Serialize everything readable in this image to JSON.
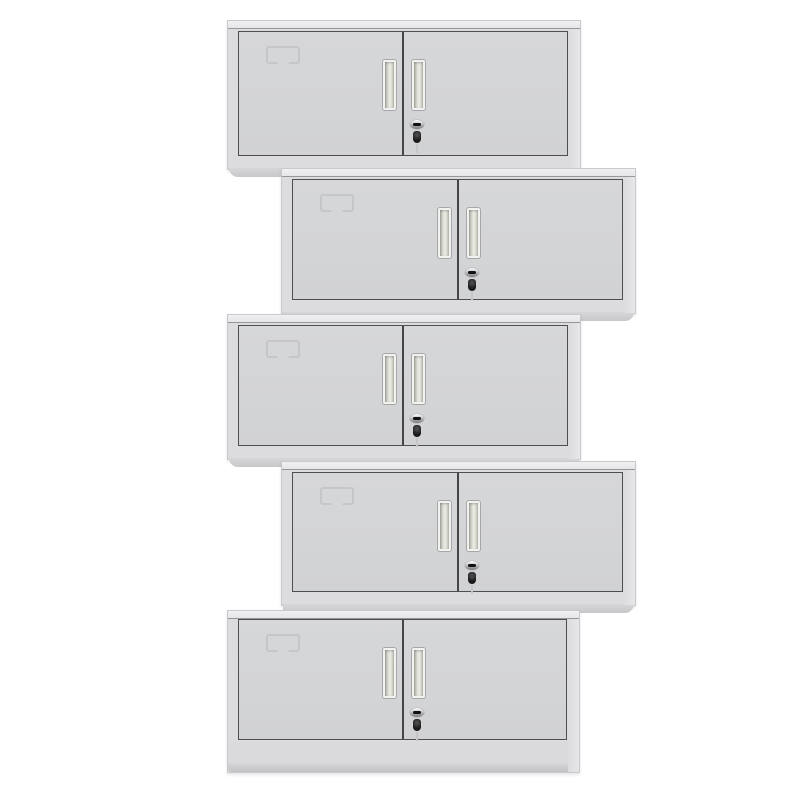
{
  "image": {
    "description": "Product photo: five grey two-door steel office cabinets stacked vertically with alternating left and right offsets on a plain white background",
    "object_count": 5
  },
  "palette": {
    "background": "#ffffff",
    "body": "#dcdcde",
    "body_edge": "#c9c9cd",
    "top_face_light": "#f0f0f2",
    "top_face": "#e6e6e8",
    "top_edge_line": "#97979b",
    "side_highlight": "#e7e7e9",
    "door_fill_top": "#d6d7d9",
    "door_fill_bottom": "#d1d2d4",
    "door_border": "#4e4e52",
    "divider": "#454547",
    "label_line": "#c3c4c6",
    "handle_frame": "#f2f2f0",
    "handle_dark": "#adafa6",
    "handle_mid": "#e0e2d9",
    "handle_light": "#eceee5",
    "handle_end": "#c2c4bb",
    "lock_chrome_light": "#ffffff",
    "lock_chrome_dark": "#77777a",
    "key_black": "#1a1a1a",
    "key_tail": "#c6c6c8",
    "foot_top": "#d6d6d8",
    "foot_bottom": "#c8c8ca",
    "base_top": "#dadadc",
    "base_bottom": "#c2c2c4"
  },
  "cabinets": [
    {
      "id": "cabinet-1",
      "align": "left",
      "x": 227,
      "y": 20,
      "width": 354,
      "height": 150,
      "base": false
    },
    {
      "id": "cabinet-2",
      "align": "right",
      "x": 281,
      "y": 168,
      "width": 355,
      "height": 146,
      "base": false
    },
    {
      "id": "cabinet-3",
      "align": "left",
      "x": 227,
      "y": 314,
      "width": 354,
      "height": 146,
      "base": false
    },
    {
      "id": "cabinet-4",
      "align": "right",
      "x": 281,
      "y": 461,
      "width": 355,
      "height": 145,
      "base": false
    },
    {
      "id": "cabinet-5",
      "align": "left",
      "x": 227,
      "y": 610,
      "width": 353,
      "height": 163,
      "base": true
    }
  ],
  "cabinet_features": {
    "doors_per_cabinet": 2,
    "handle_type": "recessed-vertical-pull",
    "lock_type": "cam-lock-with-hanging-key",
    "label_type": "embossed-card-holder"
  }
}
